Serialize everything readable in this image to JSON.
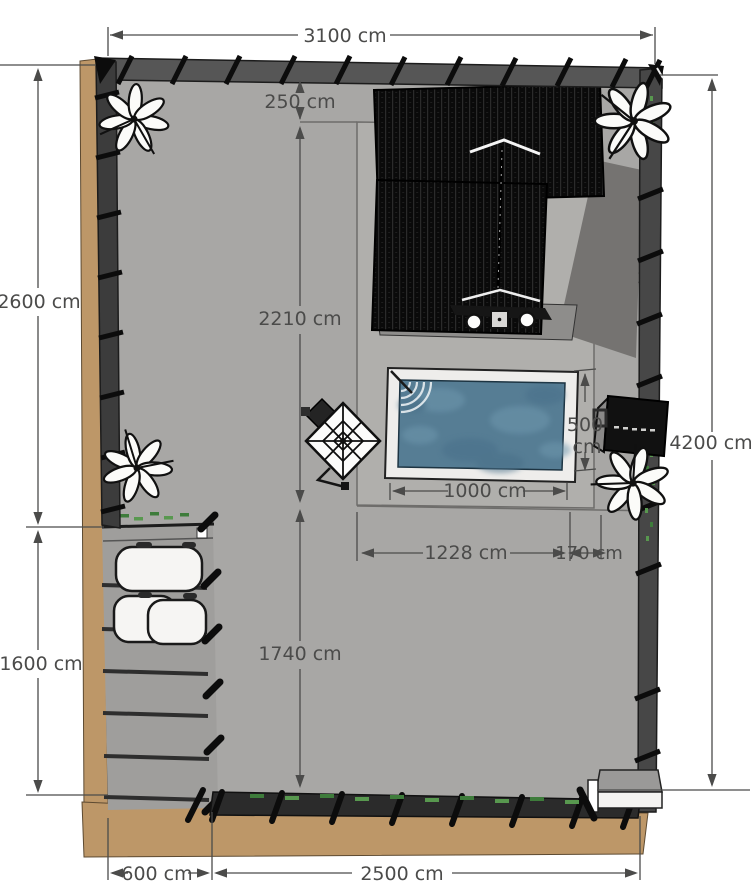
{
  "palette": {
    "yard_gray": "#a8a7a5",
    "terrace_gray": "#b0afac",
    "driveway_gray": "#9f9e9c",
    "ground_tan": "#bd9768",
    "pool_water_blue": "#567d94",
    "pool_deck_white": "#eeedeb",
    "fence_dark": "#3c3c3c",
    "roof_black": "#0c0c0c",
    "dimension_gray": "#4b4b4a",
    "plant_green": "#3e7c3b"
  },
  "dimensions": {
    "top_width": "3100 cm",
    "roof_offset_top": "250 cm",
    "left_upper_height": "2600 cm",
    "left_lower_height": "1600 cm",
    "center_upper_height": "2210 cm",
    "center_lower_height": "1740 cm",
    "right_total_height": "4200 cm",
    "right_side_offset": "250 cm",
    "pool_length": "1000 cm",
    "pool_width_value": "500",
    "pool_width_unit": "cm",
    "terrace_span": "1228 cm",
    "side_gap": "170 cm",
    "driveway_width": "600 cm",
    "bottom_span": "2500 cm"
  }
}
